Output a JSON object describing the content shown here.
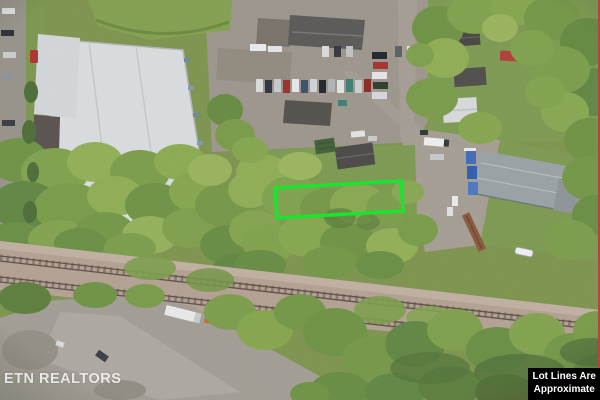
{
  "photo": {
    "watermark": "ETN REALTORS",
    "disclaimer": {
      "line1": "Lot Lines Are",
      "line2": "Approximate"
    }
  },
  "colors": {
    "lot-line": "#16e62b",
    "edge-stripe": "#b0473f",
    "label-bg": "#000000",
    "label-fg": "#ffffff",
    "watermark-fg": "#ffffff"
  }
}
